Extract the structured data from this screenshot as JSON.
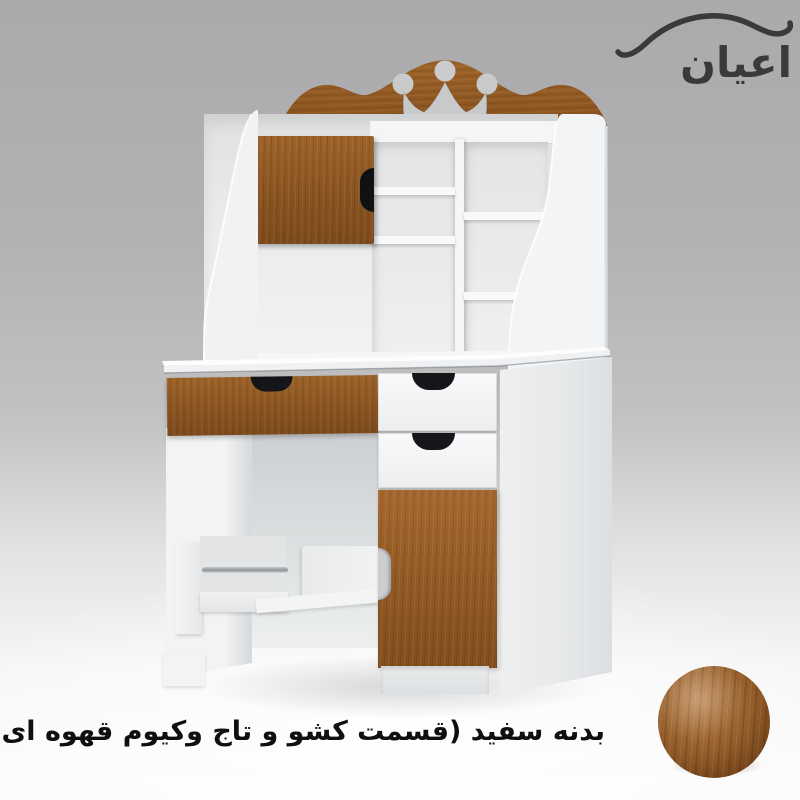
{
  "brand": {
    "logo_text": "اعیان",
    "logo_color": "#3a3a3c",
    "logo_mark": "swoosh-arc-icon"
  },
  "caption": {
    "text": "بدنه سفید (قسمت کشو و تاج وکیوم قهوه ای روشن)",
    "color": "#0f0f10"
  },
  "colors": {
    "wood_light_brown": "#8a5421",
    "wood_highlight": "#a5682f",
    "wood_dark": "#7c4a1c",
    "body_white": "#f4f5f6",
    "handle_black": "#141518",
    "wall_gray_top": "#aaaaac",
    "floor_white": "#fdfdfd"
  },
  "swatch": {
    "name": "light-brown-wood-sample",
    "base_color": "#8a5426"
  },
  "product": {
    "parts": [
      "crown-headboard",
      "crown-cutout",
      "hutch-cabinet-door",
      "hutch-shelf-cubbies",
      "side-panel-left-curved",
      "side-panel-right-curved",
      "desk-top",
      "long-wood-drawer",
      "pedestal-drawer-top",
      "pedestal-drawer-middle",
      "pedestal-wood-door",
      "book-rack-with-rail",
      "footrest-panel",
      "plinth-base"
    ]
  }
}
